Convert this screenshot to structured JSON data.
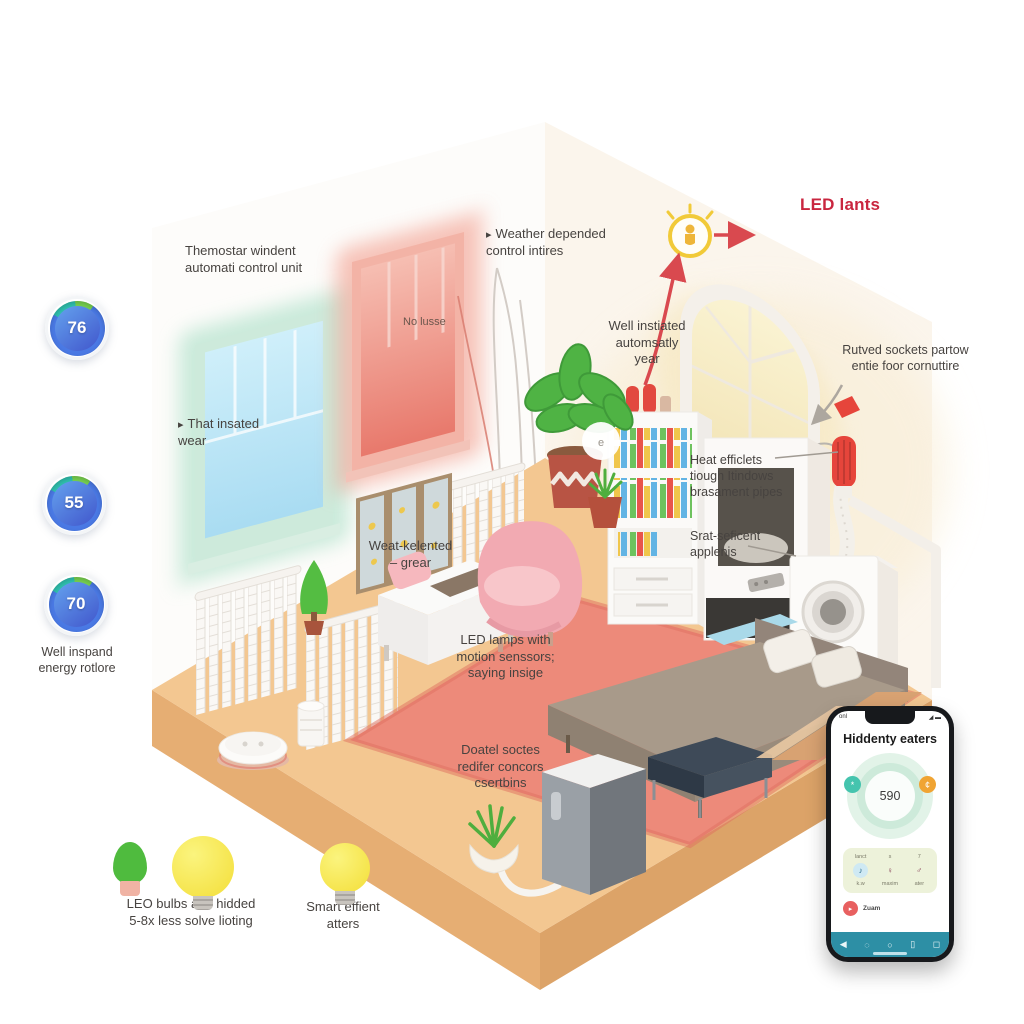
{
  "ui": {
    "marker": "▸"
  },
  "colors": {
    "accent_red": "#c9263f",
    "floor": "#f3c791",
    "rug": "#ed8a7a",
    "teal_window": "#cdeadb",
    "red_window": "#f3b3a6",
    "phone_nav": "#2d8fa5",
    "gauge_blue": "#4a79e4",
    "bulb_yellow": "#f3de38"
  },
  "gauges": {
    "items": [
      {
        "value": "76"
      },
      {
        "value": "55"
      },
      {
        "value": "70"
      }
    ],
    "caption": "Well inspand\nenergy rotlore"
  },
  "annotations": {
    "thermostat": "Themostar windent\nautomati control unit",
    "weather": "Weather depended\ncontrol intires",
    "led_lants": "LED lants",
    "well_instiated": "Well instiated\nautomsatly\nyear",
    "rutved": "Rutved sockets partow\nentie foor cornuttire",
    "that_insated": "That insated\nwear",
    "no_lusse": "No lusse",
    "weat_kelented": "Weat-kelented\n– grear",
    "heat_efficients": "Heat efficlets\ntiough Itindows\nbrasament pipes",
    "srat_seficent": "Srat-seficent\napplenis",
    "led_lamps": "LED lamps with\nmotion senssors;\nsaying insige",
    "doatel": "Doatel soctes\nredifer concors\ncsertbins",
    "led_bulbs_caption": "LEO bulbs and hidded\n5-8x less solve lioting",
    "smart_caption": "Smart effient\natters"
  },
  "room": {
    "sensor_glyph": "e"
  },
  "phone": {
    "status_left": "onl",
    "status_right": "◢ ▬",
    "title": "Hiddenty eaters",
    "gauge_value": "590",
    "badge_left": "*",
    "badge_right": "¢",
    "panel_top_labels": [
      "lanct",
      "s",
      "7"
    ],
    "panel_icons": [
      "♪",
      "♀",
      "♂"
    ],
    "panel_bottom_labels": [
      "k.w",
      "maxim",
      "ater"
    ],
    "record_icon": "▸",
    "record_label": "Zuam",
    "nav_icons": [
      "◀",
      "◌",
      "○",
      "▯",
      "◻"
    ]
  }
}
